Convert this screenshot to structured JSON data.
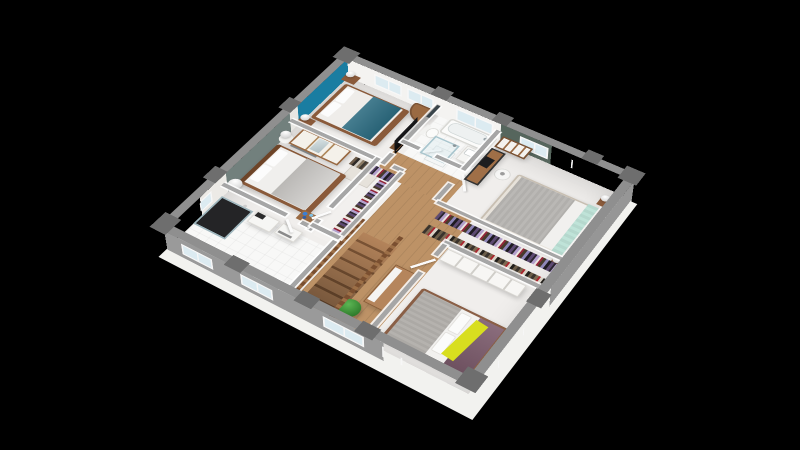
{
  "scene": {
    "description": "3D isometric render of an upper-floor house plan on a black background",
    "view": "axonometric from south-east, rotated about 33 degrees",
    "background_color": "#000000"
  },
  "palette": {
    "exterior_wall_top": "#8f8f8f",
    "exterior_wall_pier": "#6e6e6e",
    "floor_slab_edge": "#f2f2ef",
    "interior_floor": "#f0eeec",
    "wood_floor": "#bd9266",
    "teal_accent_wall": "#1a7da1",
    "gray_accent_wall": "#72807d",
    "green_accent_wall": "#56665d",
    "teal_bed_runner": "#2c6b80",
    "mint_bed_runner": "#bfe3d8",
    "yellow_throw": "#d8de1f",
    "purple_bedspread": "#7d5c6d",
    "wood_furniture": "#9a6b45",
    "dark_wood": "#7a5335",
    "plant_green": "#2f7c2c",
    "shower_dark_tile": "#242426"
  },
  "rooms": [
    {
      "id": "bedroom-1",
      "label": "bedroom with teal accent wall",
      "accent_wall_color": "#1a7da1",
      "furniture": [
        "double-bed",
        "teal-bed-runner",
        "nightstand-with-lamp-left",
        "nightstand-with-lamp-right",
        "tv",
        "tv-cabinet",
        "curved-wood-desk",
        "wardrobe-with-mirror",
        "open-clothes-niche"
      ]
    },
    {
      "id": "bedroom-2",
      "label": "bedroom with gray accent wall",
      "accent_wall_color": "#72807d",
      "furniture": [
        "double-bed",
        "gray-blanket",
        "round-nightstand-with-sphere-lamp",
        "sphere-floor-lamp",
        "gray-dresser",
        "decor-table-with-blue-items"
      ]
    },
    {
      "id": "bathroom",
      "label": "family bathroom",
      "furniture": [
        "bathtub",
        "toilet",
        "glass-shower",
        "vanity-sink",
        "wall-mirror"
      ]
    },
    {
      "id": "shower-room",
      "label": "en-suite shower room",
      "furniture": [
        "dark-tiled-shower",
        "vanity-unit",
        "storage-unit"
      ]
    },
    {
      "id": "dressing",
      "label": "walk-in closet off the hallway",
      "furniture": [
        "clothes-rail-north",
        "clothes-rail-east"
      ]
    },
    {
      "id": "bedroom-3",
      "label": "bedroom with green accent wall",
      "accent_wall_color": "#56665d",
      "furniture": [
        "double-bed",
        "mint-bed-runner",
        "nightstand-with-lamp-upper",
        "nightstand-with-lamp-lower",
        "bookshelf",
        "desk",
        "laptop",
        "desk-chair",
        "closet-rail-upper",
        "closet-rail-lower"
      ]
    },
    {
      "id": "bedroom-4",
      "label": "bedroom at the lower corner",
      "furniture": [
        "double-bed",
        "gray-duvet",
        "purple-bedspread",
        "yellow-throw",
        "white-wardrobe-row"
      ]
    },
    {
      "id": "hallway",
      "label": "landing and corridor",
      "furniture": [
        "wood-staircase",
        "wood-balustrade-left",
        "wood-balustrade-right",
        "sideboard",
        "potted-plant"
      ]
    }
  ],
  "openings": {
    "windows_northeast": 5,
    "windows_southeast": 2,
    "windows_southwest": 4,
    "windows_northwest": 1,
    "open_doors": 7
  },
  "stairs": {
    "material": "wood",
    "descends_toward": "south-west facade"
  }
}
